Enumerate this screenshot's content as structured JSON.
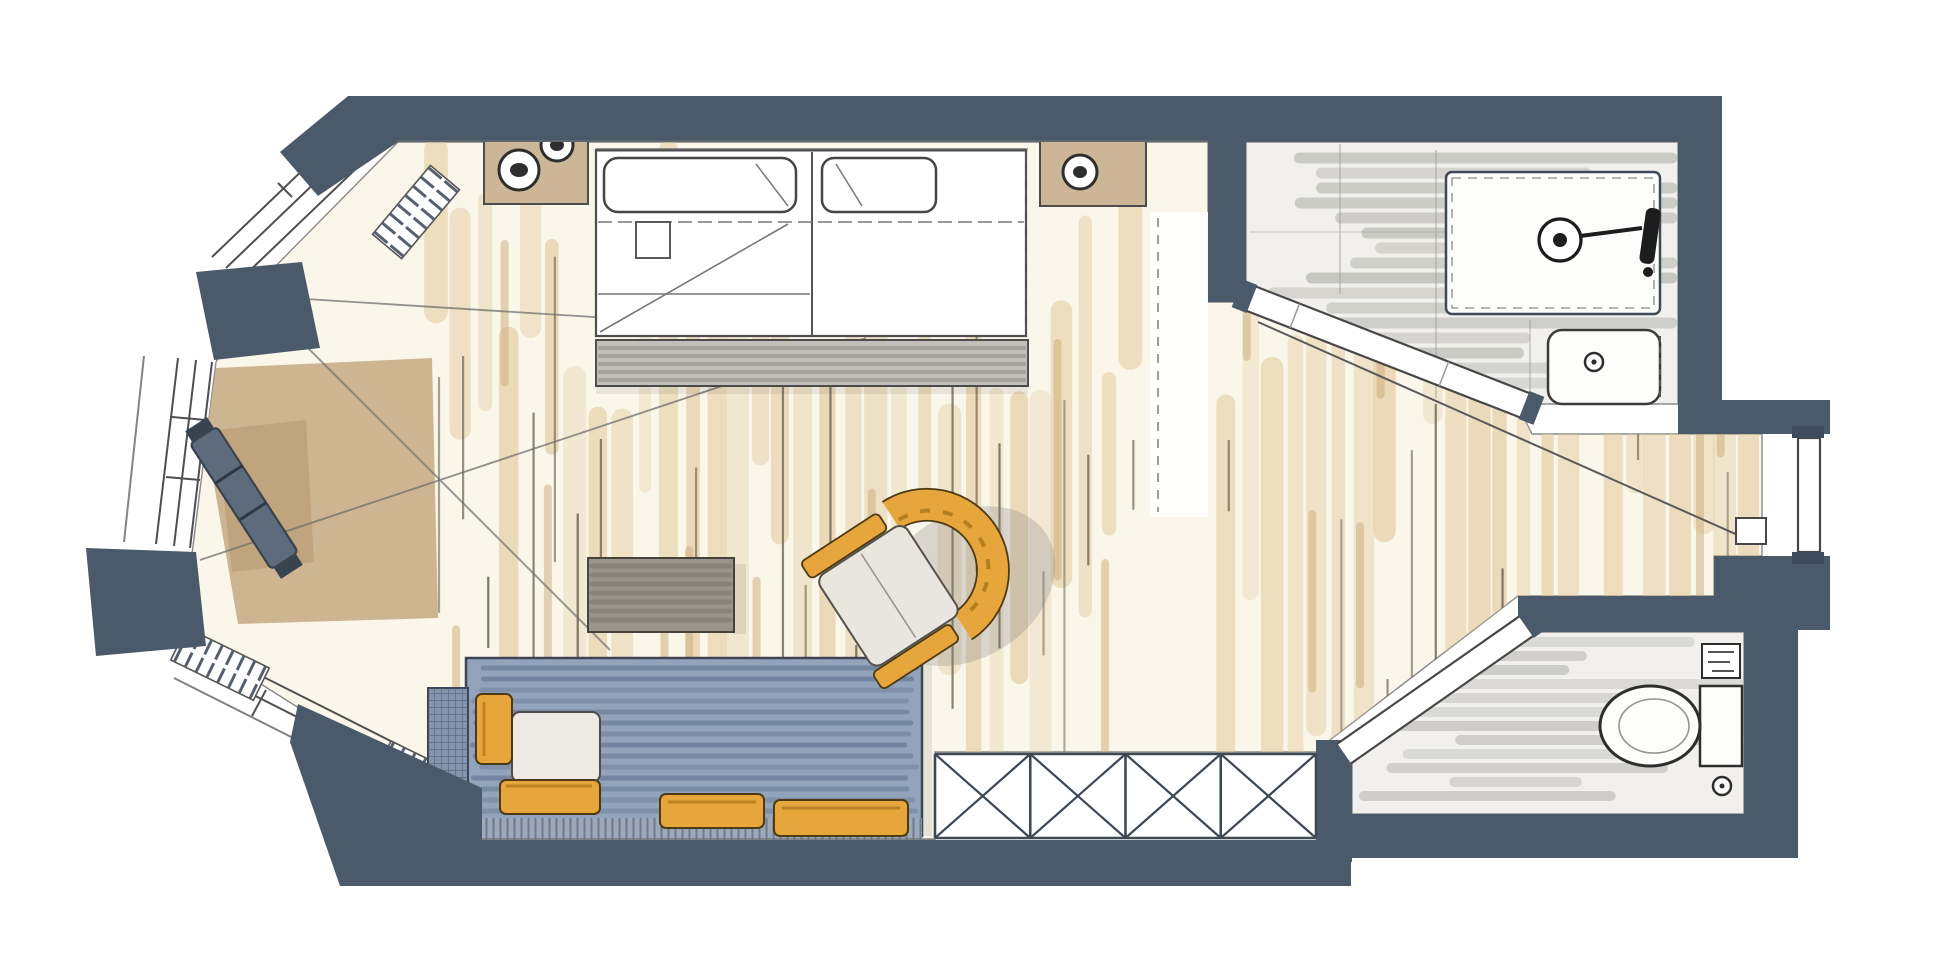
{
  "document": {
    "title": "Hand-drawn hotel room floor plan (marker sketch)",
    "type": "floor-plan",
    "canvas": {
      "width": 1950,
      "height": 959
    }
  },
  "palette": {
    "paper": "#ffffff",
    "wall": "#4a5a6b",
    "wall_dark": "#3d4b5c",
    "outline": "#424c59",
    "pencil": "#6f6f6f",
    "wood_base": "#fbf6ea",
    "rug": "#c9ae88",
    "rug_dark": "#b4966c",
    "tile_floor": "#f1f0ed",
    "sofa": "#93a3bb",
    "sofa_deep": "#8494ac",
    "accent": "#e7a63c",
    "accent_dark": "#a9751a",
    "table": "#9a958b",
    "footboard": "#c2bfb8",
    "fixture_white": "#fdfdfb",
    "stand": "#cdb697"
  },
  "rooms": {
    "bedroom": {
      "label": "Bedroom and living area with oak plank floor"
    },
    "bay": {
      "label": "Bay window alcove with three windows"
    },
    "bathroom": {
      "label": "Bathroom with shower and washbasin"
    },
    "wc": {
      "label": "Separate WC with toilet"
    },
    "entry": {
      "label": "Entry corridor with entrance door"
    }
  },
  "furniture": {
    "bed": {
      "label": "Double bed with two pillows"
    },
    "nightstand_left": {
      "label": "Nightstand with two cups"
    },
    "nightstand_right": {
      "label": "Nightstand with lamp"
    },
    "footboard": {
      "label": "Bench at foot of bed"
    },
    "desk": {
      "label": "Gray side table"
    },
    "armchair": {
      "label": "Yellow lounge armchair"
    },
    "sofa": {
      "label": "Blue daybed sofa with yellow cushions"
    },
    "luggage_bench": {
      "label": "Luggage bench in bay"
    },
    "radiators": {
      "label": "Radiators under bay windows"
    },
    "shower": {
      "label": "Walk-in shower"
    },
    "sink": {
      "label": "Washbasin"
    },
    "toilet": {
      "label": "Toilet with cistern"
    },
    "railing": {
      "label": "French balcony X railing"
    }
  },
  "textures": {
    "seed": 7,
    "wood": {
      "x0": 436,
      "x1": 1756,
      "step": 19,
      "stroke": "224,199,152",
      "dark": "203,170,118",
      "line": "110,100,82"
    },
    "bath": {
      "streak": "176,176,170"
    },
    "wc": {
      "streak": "179,179,174"
    },
    "sofa": {
      "streak": "92,110,140"
    },
    "table": {
      "streak": "120,115,105"
    },
    "footboard": {
      "streak": "142,139,132"
    },
    "railing": {
      "x0": 935,
      "x1": 1316,
      "cells": 4,
      "y0": 754,
      "y1": 838
    }
  }
}
